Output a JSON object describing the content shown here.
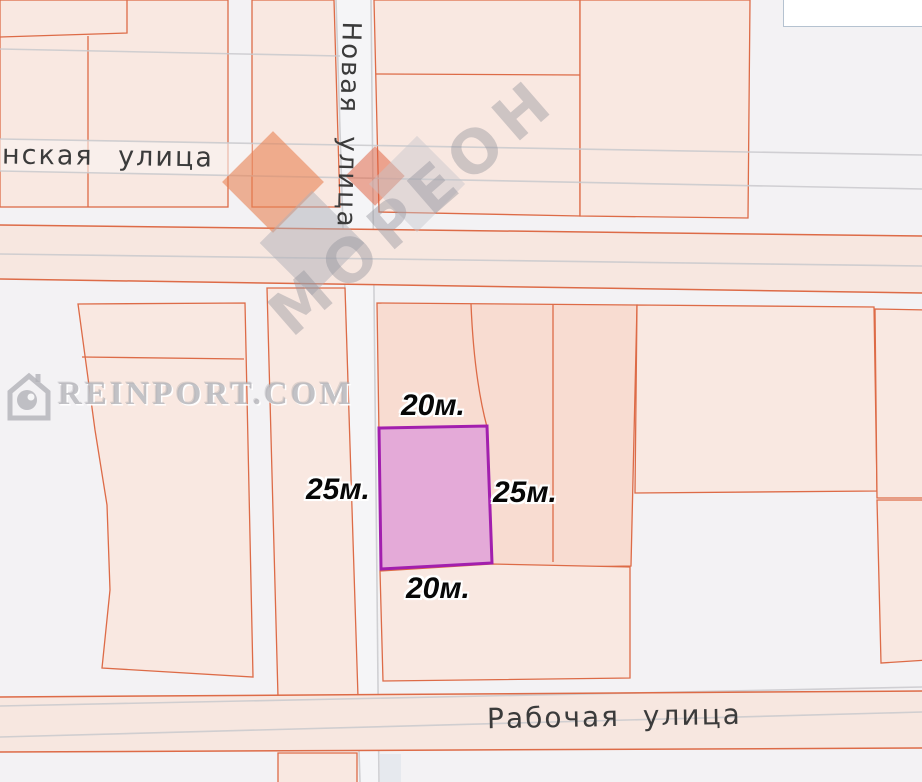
{
  "map": {
    "streets": {
      "vertical_name": "Новая улица",
      "top_left_name": "нская улица",
      "bottom_name": "Рабочая улица"
    },
    "plot_dimensions": {
      "top": "20м.",
      "left": "25м.",
      "right": "25м.",
      "bottom": "20м."
    },
    "watermarks": {
      "logo_text": "МОРЕОН",
      "site_text": "REINPORT.COM"
    },
    "colors": {
      "bg": "#f3f2f4",
      "parcel-light": "#f9e8e1",
      "parcel-salmon": "#f8dcd1",
      "cad-line": "#dd6b47",
      "street-fill": "#f7e7e0",
      "gray-line": "#c9c9cd",
      "white-street": "#f5f5f7",
      "plot-fill": "#e4aad8",
      "plot-stroke": "#a21fae"
    }
  }
}
